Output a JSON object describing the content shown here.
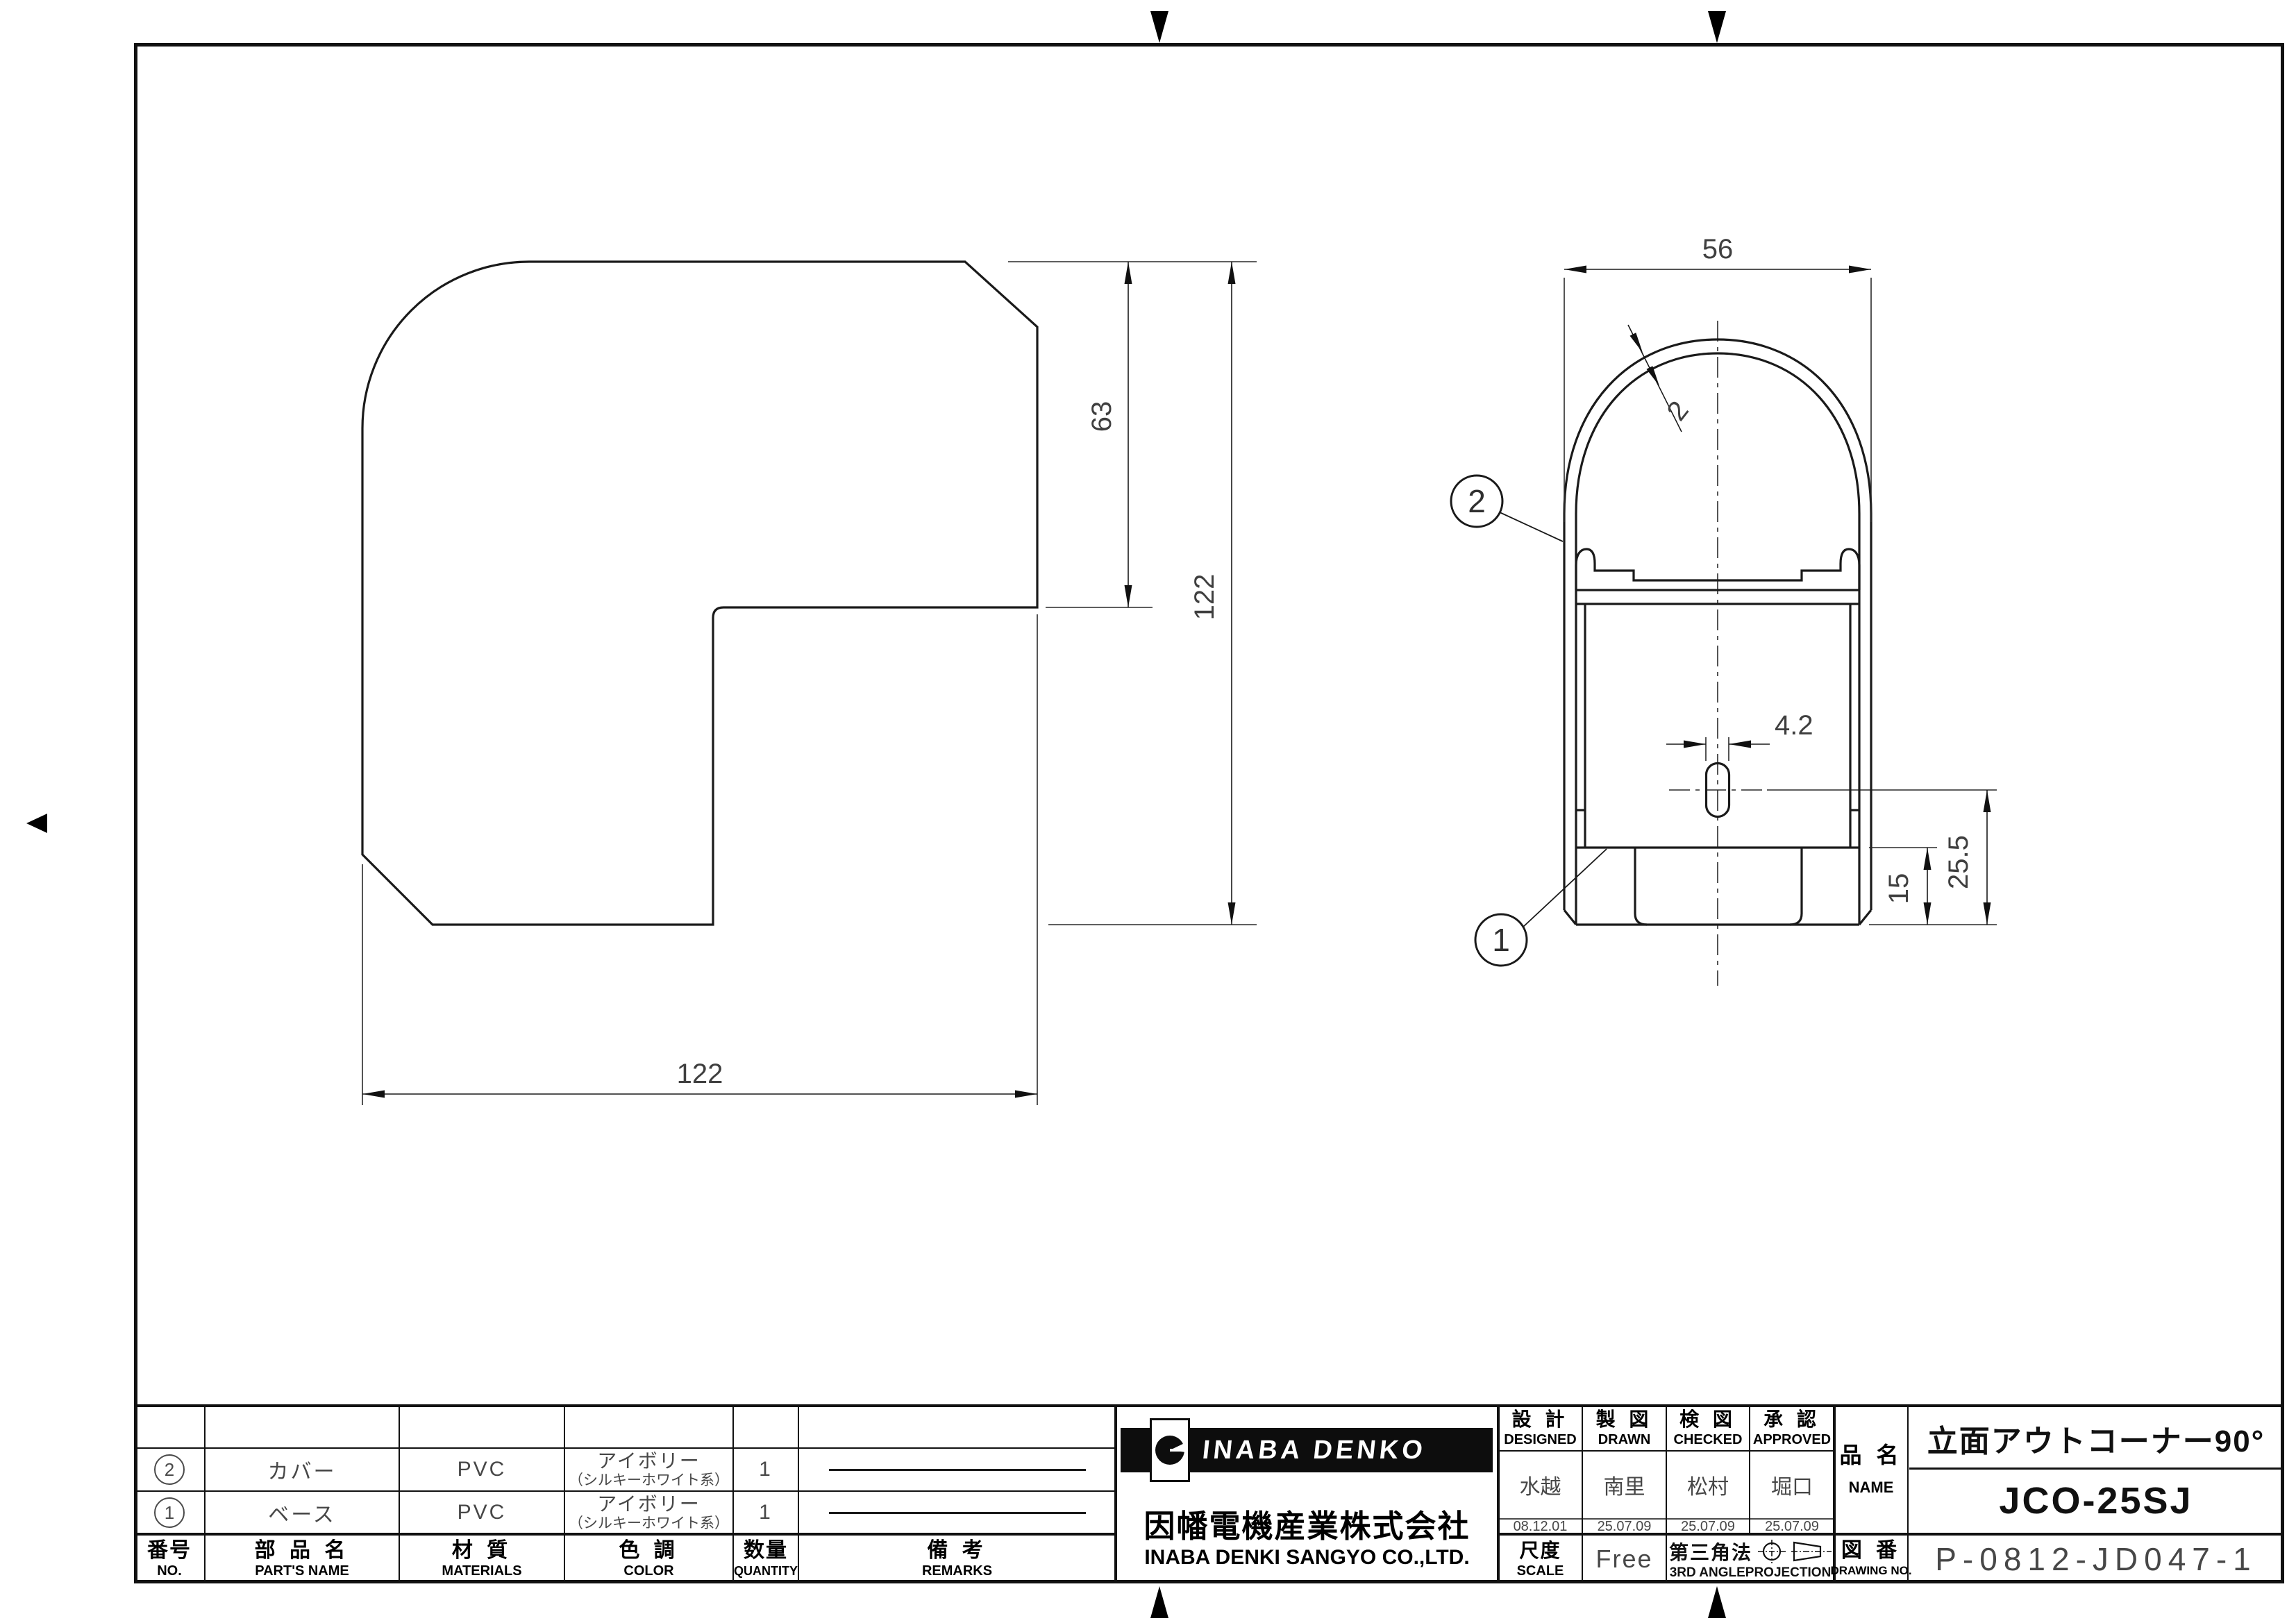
{
  "colors": {
    "ink": "#111111",
    "cad_text": "#454545",
    "paper": "#ffffff"
  },
  "drawing": {
    "left_view": {
      "dim_height_63": "63",
      "dim_height_122": "122",
      "dim_width_122": "122"
    },
    "right_view": {
      "dim_width": "56",
      "dim_thickness": "2",
      "dim_slot_width": "4.2",
      "dim_slot_center_to_bottom": "25.5",
      "dim_flange_height": "15",
      "balloon_cover": "2",
      "balloon_base": "1"
    }
  },
  "title_block": {
    "parts_table": {
      "headers": {
        "no_jp": "番号",
        "no_en": "NO.",
        "name_jp": "部 品 名",
        "name_en": "PART'S NAME",
        "material_jp": "材 質",
        "material_en": "MATERIALS",
        "color_jp": "色 調",
        "color_en": "COLOR",
        "qty_jp": "数量",
        "qty_en": "QUANTITY",
        "remarks_jp": "備  考",
        "remarks_en": "REMARKS"
      },
      "rows": [
        {
          "no": "2",
          "name": "カバー",
          "material": "PVC",
          "color_main": "アイボリー",
          "color_sub": "（シルキーホワイト系）",
          "qty": "1"
        },
        {
          "no": "1",
          "name": "ベース",
          "material": "PVC",
          "color_main": "アイボリー",
          "color_sub": "（シルキーホワイト系）",
          "qty": "1"
        }
      ]
    },
    "maker": {
      "brand": "INABA DENKO",
      "company_jp": "因幡電機産業株式会社",
      "company_en": "INABA DENKI SANGYO CO.,LTD."
    },
    "signoff": {
      "columns": [
        {
          "jp": "設 計",
          "en": "DESIGNED",
          "name": "水越",
          "date": "08.12.01"
        },
        {
          "jp": "製 図",
          "en": "DRAWN",
          "name": "南里",
          "date": "25.07.09"
        },
        {
          "jp": "検 図",
          "en": "CHECKED",
          "name": "松村",
          "date": "25.07.09"
        },
        {
          "jp": "承 認",
          "en": "APPROVED",
          "name": "堀口",
          "date": "25.07.09"
        }
      ]
    },
    "scale": {
      "jp": "尺度",
      "en": "SCALE",
      "value": "Free"
    },
    "projection": {
      "jp": "第三角法",
      "en": "3RD ANGLEPROJECTION"
    },
    "name_block": {
      "jp": "品 名",
      "en": "NAME",
      "product": "立面アウトコーナー90°",
      "model": "JCO-25SJ"
    },
    "drawing_no": {
      "jp": "図 番",
      "en": "DRAWING NO.",
      "value": "P-0812-JD047-1"
    }
  }
}
